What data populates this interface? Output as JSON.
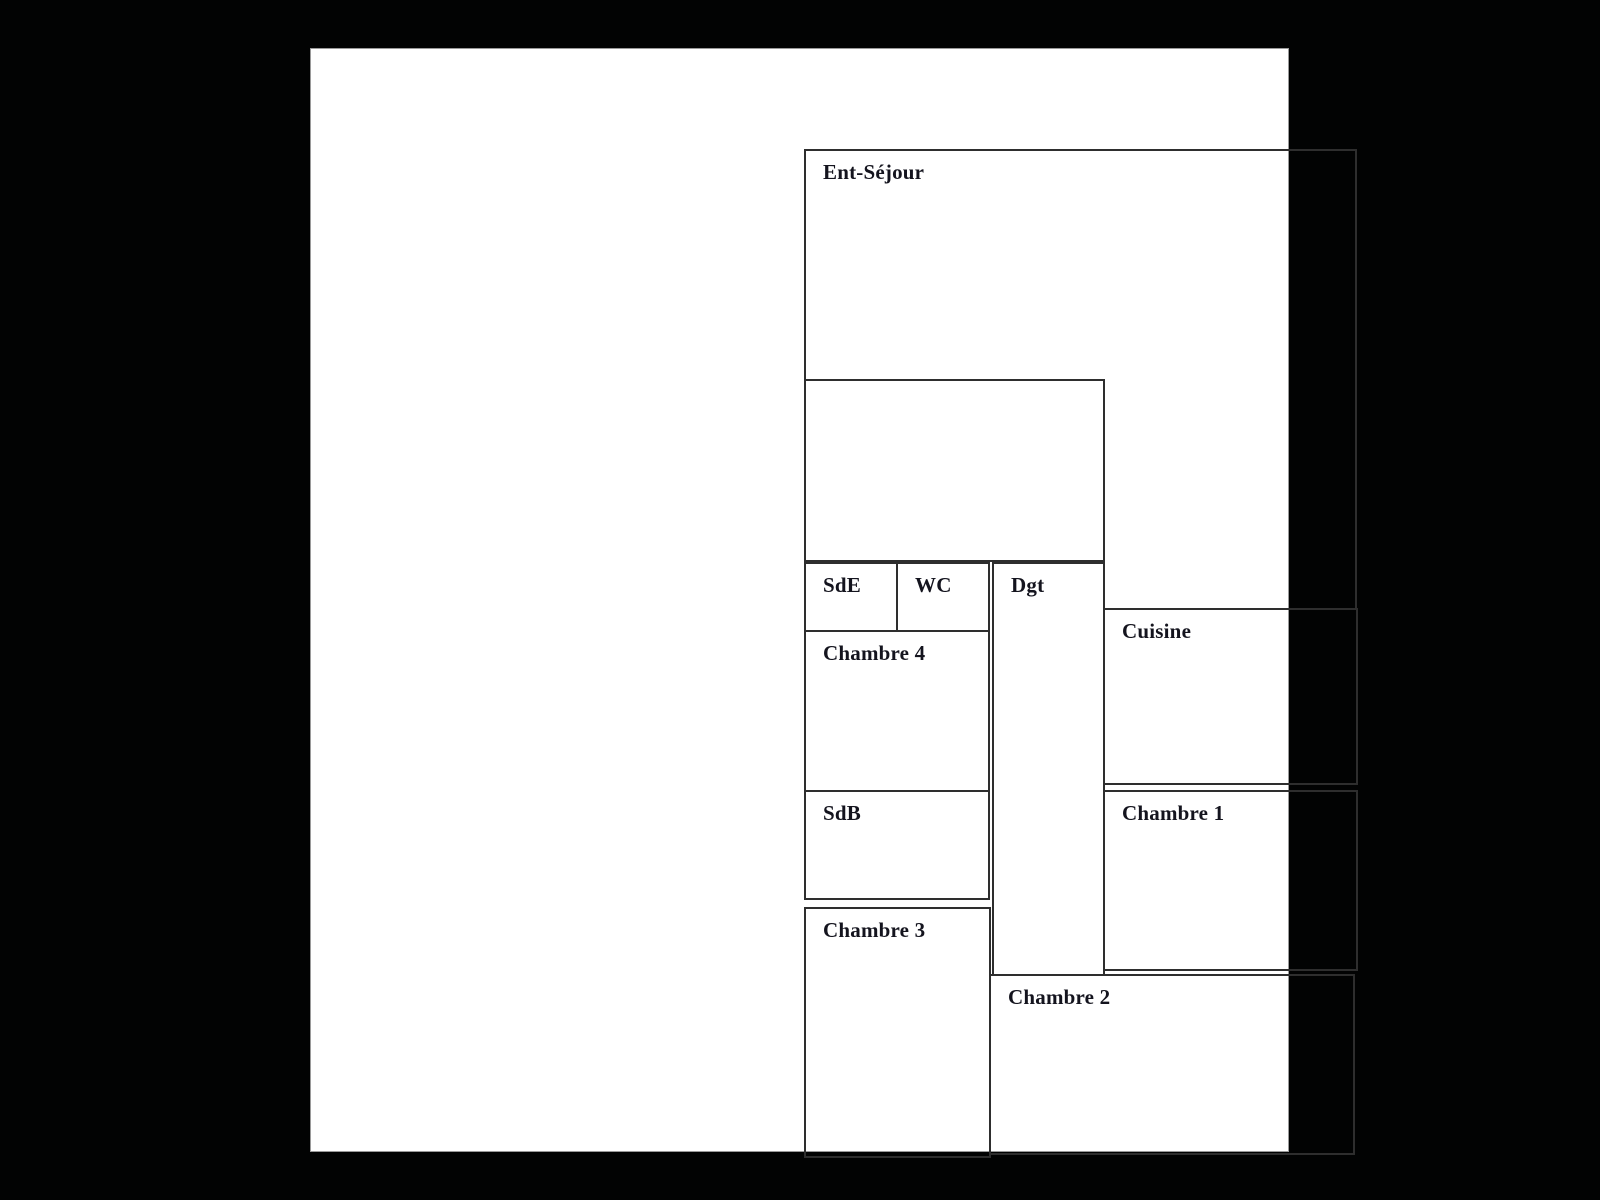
{
  "viewer": {
    "backdrop_color": "#020303",
    "page_color": "#ffffff"
  },
  "floor_plan": {
    "line_color": "#2e2e2e",
    "text_color": "#14141e",
    "rooms": [
      {
        "id": "ent-sejour",
        "label": "Ent-Séjour"
      },
      {
        "id": "annex",
        "label": ""
      },
      {
        "id": "sde",
        "label": "SdE"
      },
      {
        "id": "wc",
        "label": "WC"
      },
      {
        "id": "dgt",
        "label": "Dgt"
      },
      {
        "id": "chambre4",
        "label": "Chambre 4"
      },
      {
        "id": "sdb",
        "label": "SdB"
      },
      {
        "id": "cuisine",
        "label": "Cuisine"
      },
      {
        "id": "chambre1",
        "label": "Chambre 1"
      },
      {
        "id": "chambre3",
        "label": "Chambre 3"
      },
      {
        "id": "chambre2",
        "label": "Chambre 2"
      }
    ]
  }
}
